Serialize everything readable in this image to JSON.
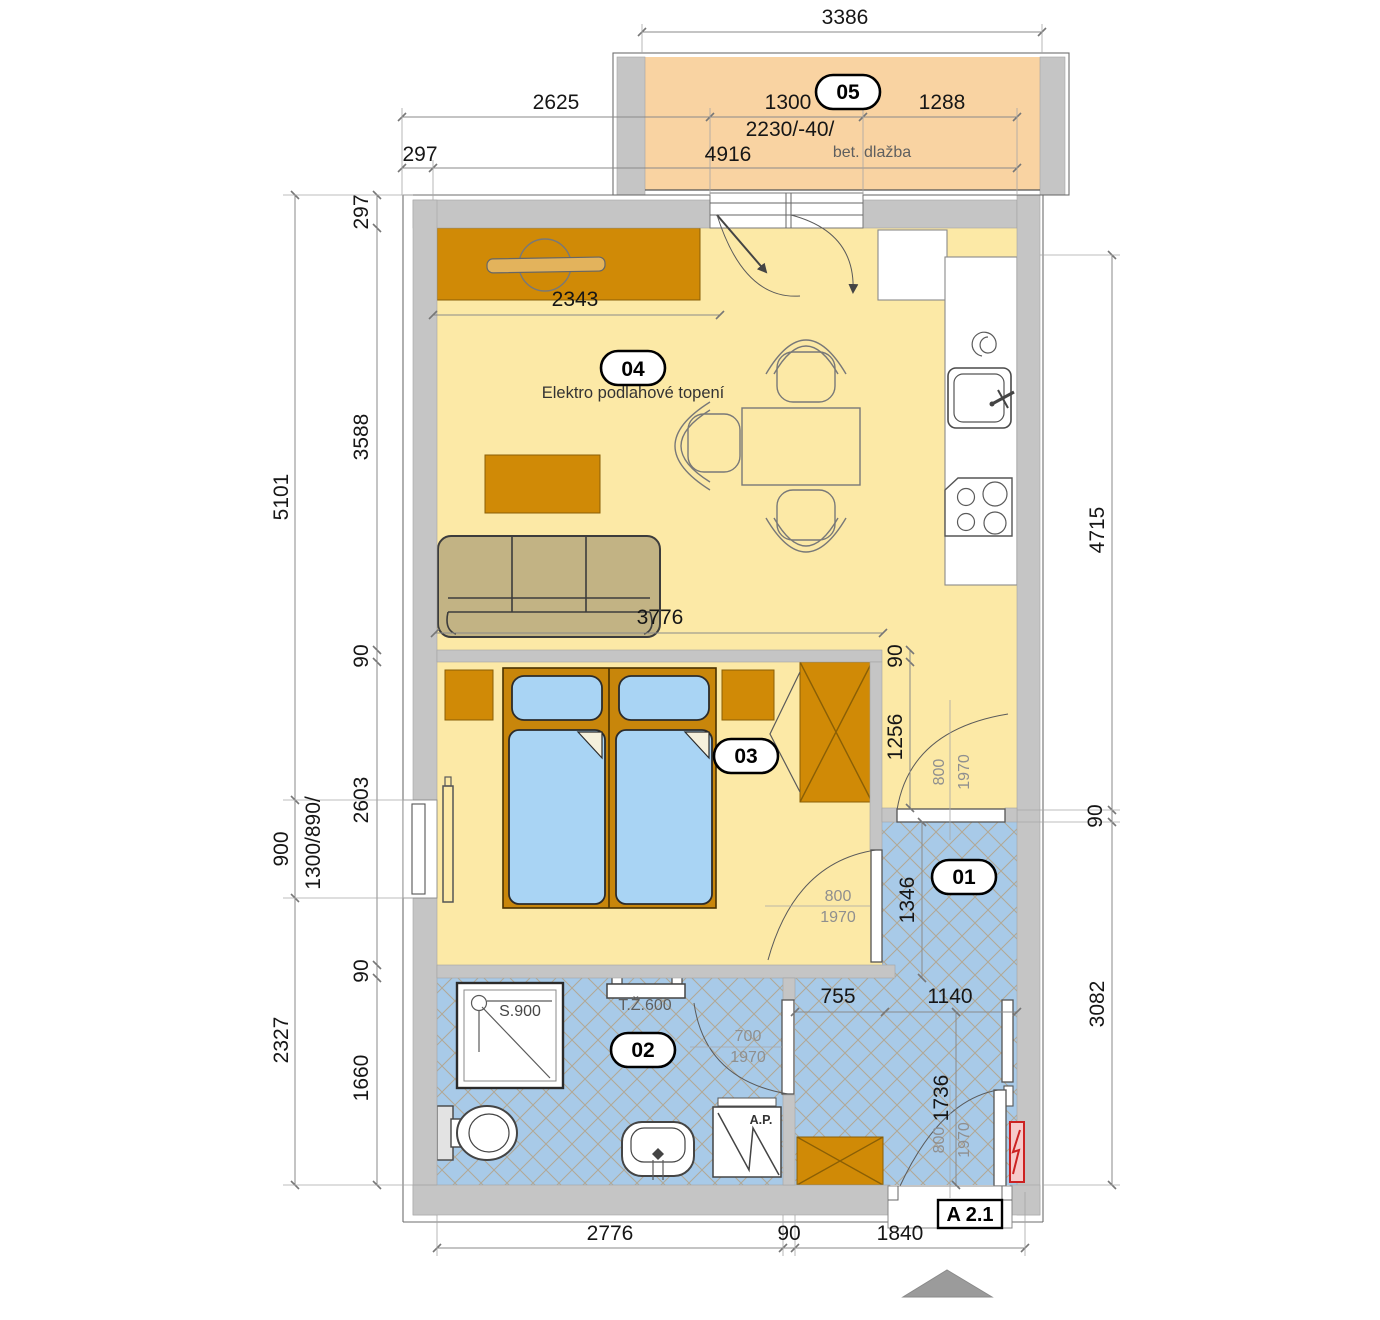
{
  "colors": {
    "wall": "#c5c5c5",
    "floor_dry": "#fce9a6",
    "floor_balcony": "#f9d3a2",
    "floor_wet": "#a8cae8",
    "furniture": "#d08a06",
    "bed_blue": "#a9d4f4",
    "sofa": "#c2b384",
    "panel_red": "#cc2222"
  },
  "rooms": {
    "room01": {
      "id": "01"
    },
    "room02": {
      "id": "02"
    },
    "room03": {
      "id": "03"
    },
    "room04": {
      "id": "04",
      "note": "Elektro podlahové topení"
    },
    "room05": {
      "id": "05",
      "floor_note": "bet. dlažba"
    }
  },
  "dims": {
    "top": {
      "total": "3386",
      "offset_left": "2625",
      "balcony_door": "1300",
      "balcony_right": "1288",
      "opening": "2230/-40/",
      "wall": "297",
      "overall": "4916"
    },
    "left_outer": {
      "upper": "5101",
      "window": "900",
      "window_size": "1300/890/",
      "lower": "2327"
    },
    "left_inner": {
      "wall": "297",
      "living": "3588",
      "partition_top": "90",
      "bedroom": "2603",
      "partition_bottom": "90",
      "bathroom": "1660"
    },
    "right": {
      "upper": "4715",
      "wall": "90",
      "lower": "3082"
    },
    "inner": {
      "tv_wall": "2343",
      "living_width": "3776",
      "bedroom_wall": "90",
      "corridor": "1256",
      "hall_upper": "1346",
      "hall_left": "755",
      "hall_right": "1140",
      "hall_height": "1736"
    },
    "bottom": {
      "bathroom": "2776",
      "wall": "90",
      "entry": "1840"
    }
  },
  "doors": {
    "corridor": {
      "width": "800",
      "height": "1970"
    },
    "bedroom": {
      "width": "800",
      "height": "1970"
    },
    "bathroom": {
      "width": "700",
      "height": "1970"
    },
    "entrance": {
      "width": "800",
      "height": "1970"
    }
  },
  "fixtures": {
    "shower": "S.900",
    "towel_radiator": "T.Ž.600",
    "washing_machine": "A.P."
  },
  "marks": {
    "section": "A 2.1"
  }
}
